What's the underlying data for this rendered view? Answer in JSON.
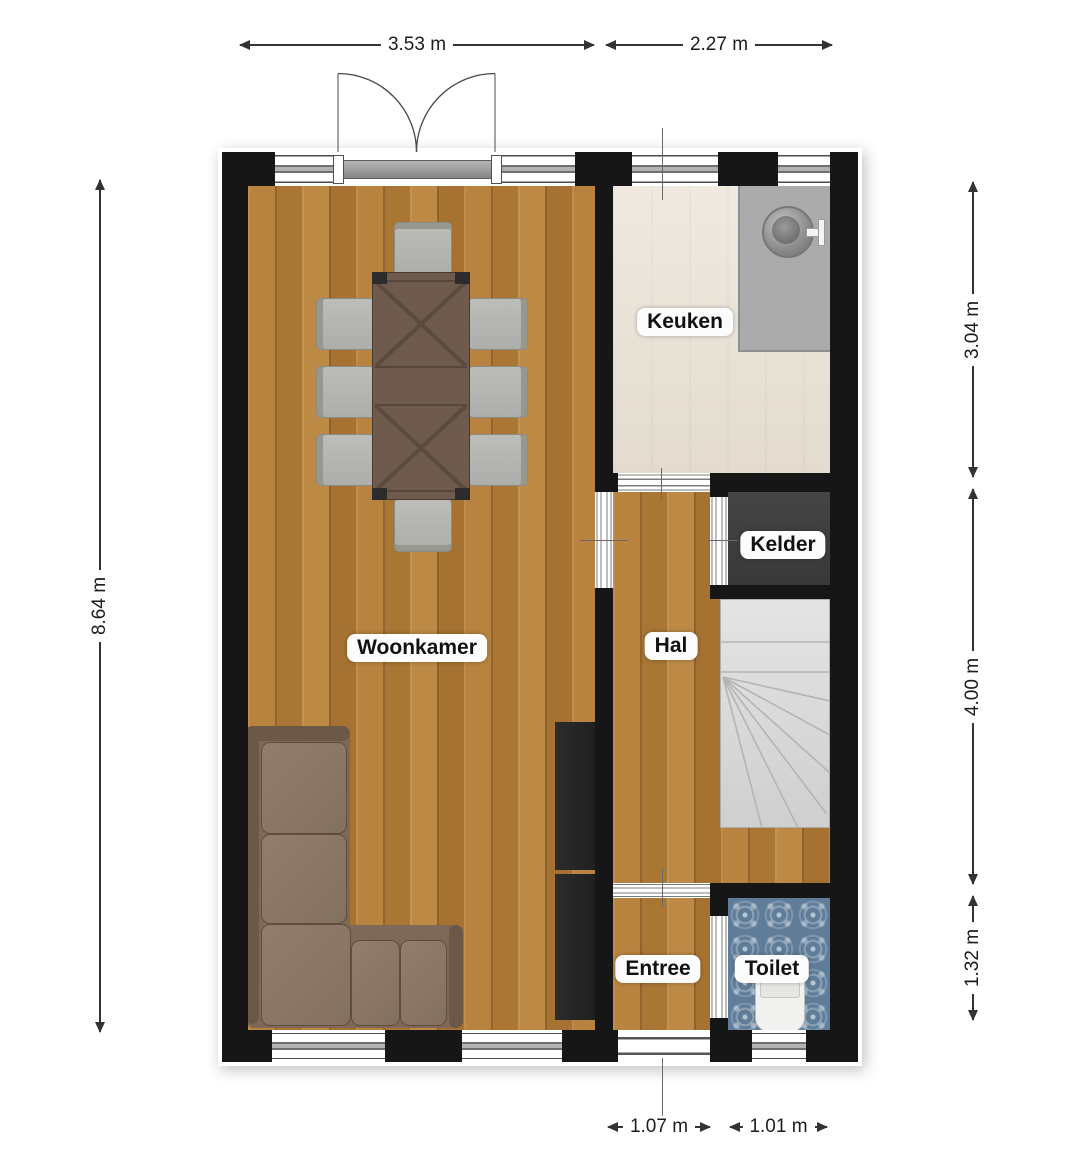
{
  "plan": {
    "type": "floor-plan",
    "style": "2D top-down real-estate floorplan"
  },
  "rooms": [
    {
      "id": "woonkamer",
      "label": "Woonkamer"
    },
    {
      "id": "keuken",
      "label": "Keuken"
    },
    {
      "id": "kelder",
      "label": "Kelder"
    },
    {
      "id": "hal",
      "label": "Hal"
    },
    {
      "id": "entree",
      "label": "Entree"
    },
    {
      "id": "toilet",
      "label": "Toilet"
    }
  ],
  "dimensions": {
    "top": [
      {
        "value": "3.53 m"
      },
      {
        "value": "2.27 m"
      }
    ],
    "left": [
      {
        "value": "8.64 m"
      }
    ],
    "right": [
      {
        "value": "3.04 m"
      },
      {
        "value": "4.00 m"
      },
      {
        "value": "1.32 m"
      }
    ],
    "bottom": [
      {
        "value": "1.07 m"
      },
      {
        "value": "1.01 m"
      }
    ]
  },
  "furniture": [
    {
      "name": "dining-table"
    },
    {
      "name": "dining-chair",
      "count": 8
    },
    {
      "name": "corner-sofa"
    },
    {
      "name": "tall-cabinet"
    },
    {
      "name": "kitchen-counter"
    },
    {
      "name": "kitchen-sink"
    },
    {
      "name": "staircase"
    },
    {
      "name": "toilet-fixture"
    },
    {
      "name": "french-doors"
    }
  ],
  "colors": {
    "wall": "#161616",
    "wood_floor": "#b07c3a",
    "kitchen_floor": "#eae2d5",
    "kelder_floor": "#3e3e3e",
    "stairs": "#dcdcdc",
    "toilet_tile": "#5f7d99",
    "counter": "#ababab",
    "sofa": "#7e6958",
    "table": "#6e5b4e",
    "chair": "#b6b6b2"
  }
}
